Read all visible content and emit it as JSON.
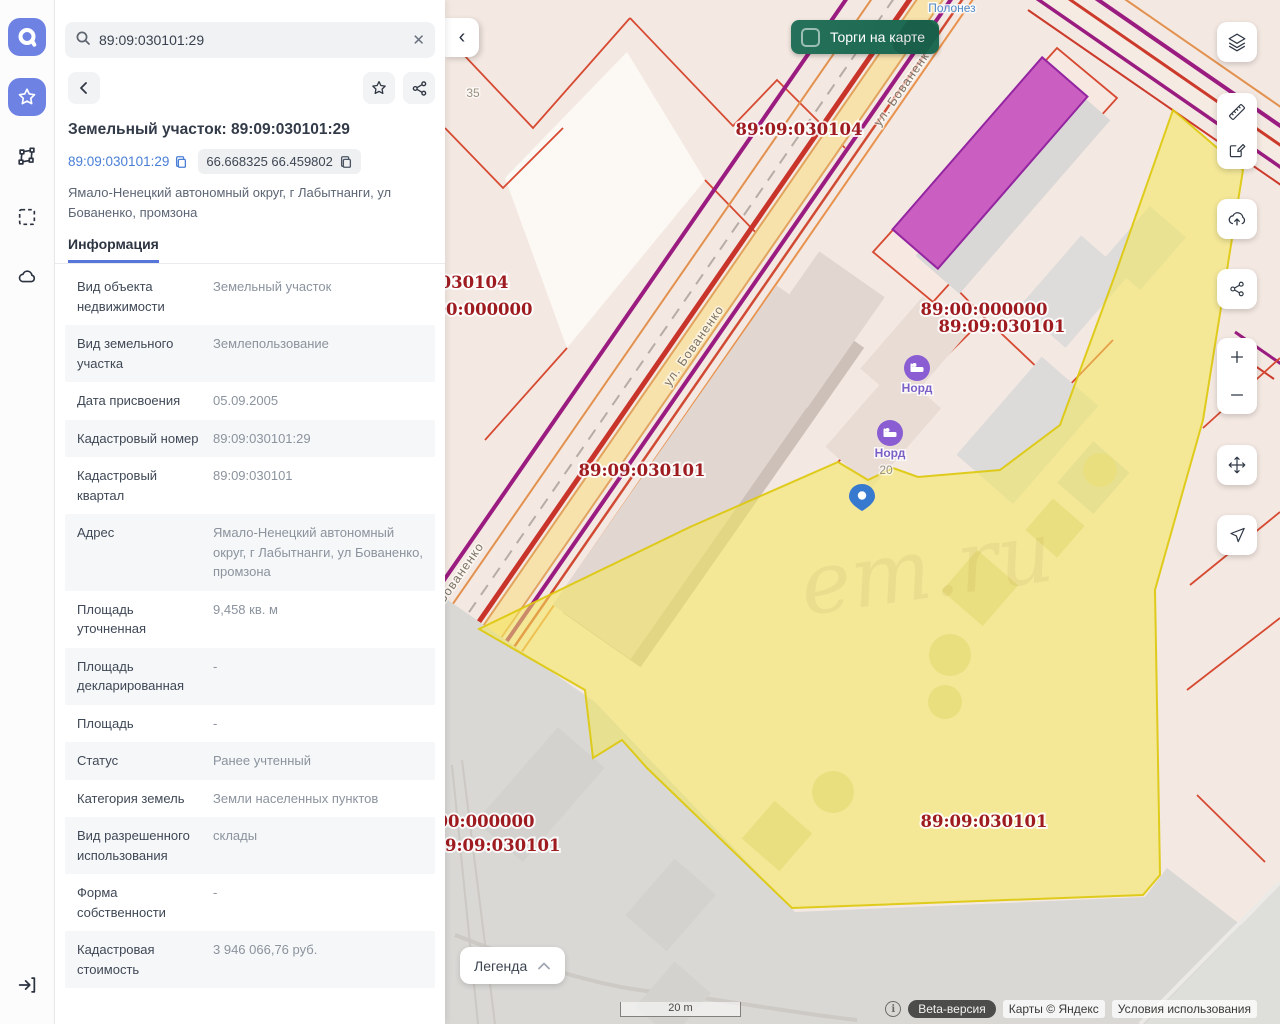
{
  "colors": {
    "accent_blue": "#6d82e3",
    "link_blue": "#4a7fd6",
    "tab_blue": "#5677d9",
    "toggle_green": "#1e6a52",
    "cad_red": "#9e1b20",
    "parcel_yellow": "#f2e261",
    "pin_blue": "#3879d0",
    "poi_purple": "#8a5ed2"
  },
  "rail": {
    "items": [
      "app-logo",
      "favorites",
      "polygon-select",
      "area-select",
      "cloud",
      "sign-in"
    ]
  },
  "search": {
    "value": "89:09:030101:29"
  },
  "details": {
    "title": "Земельный участок: 89:09:030101:29",
    "cadastral_link": "89:09:030101:29",
    "coordinates": "66.668325 66.459802",
    "address": "Ямало-Ненецкий автономный округ, г Лабытнанги, ул Бованенко, промзона",
    "tab": "Информация",
    "rows": [
      {
        "label": "Вид объекта недвижимости",
        "value": "Земельный участок"
      },
      {
        "label": "Вид земельного участка",
        "value": "Землепользование"
      },
      {
        "label": "Дата присвоения",
        "value": "05.09.2005"
      },
      {
        "label": "Кадастровый номер",
        "value": "89:09:030101:29"
      },
      {
        "label": "Кадастровый квартал",
        "value": "89:09:030101"
      },
      {
        "label": "Адрес",
        "value": "Ямало-Ненецкий автономный округ, г Лабытнанги, ул Бованенко, промзона"
      },
      {
        "label": "Площадь уточненная",
        "value": "9,458 кв. м"
      },
      {
        "label": "Площадь декларированная",
        "value": "-"
      },
      {
        "label": "Площадь",
        "value": "-"
      },
      {
        "label": "Статус",
        "value": "Ранее учтенный"
      },
      {
        "label": "Категория земель",
        "value": "Земли населенных пунктов"
      },
      {
        "label": "Вид разрешенного использования",
        "value": "склады"
      },
      {
        "label": "Форма собственности",
        "value": "-"
      },
      {
        "label": "Кадастровая стоимость",
        "value": "3 946 066,76 руб."
      }
    ]
  },
  "map": {
    "toggle_label": "Торги на карте",
    "legend_label": "Легенда",
    "scale_label": "20 m",
    "beta_label": "Beta-версия",
    "attribution": "Карты © Яндекс",
    "terms": "Условия использования",
    "controls": [
      "layers",
      "measure",
      "draw",
      "upload",
      "share",
      "zoom-in",
      "zoom-out",
      "pan",
      "locate"
    ],
    "labels": [
      {
        "text": "89:09:030104",
        "kind": "cadastral",
        "x": 354,
        "y": 135
      },
      {
        "text": "89:09:030104",
        "kind": "cadastral",
        "x": 0,
        "y": 288
      },
      {
        "text": "89:00:000000",
        "kind": "cadastral",
        "x": 24,
        "y": 315
      },
      {
        "text": "89:00:000000",
        "kind": "cadastral",
        "x": 539,
        "y": 315
      },
      {
        "text": "89:09:030101",
        "kind": "cadastral",
        "x": 557,
        "y": 332
      },
      {
        "text": "89:09:030101",
        "kind": "cadastral",
        "x": 197,
        "y": 476
      },
      {
        "text": "89:00:000000",
        "kind": "cadastral",
        "x": 26,
        "y": 827
      },
      {
        "text": "89:09:030101",
        "kind": "cadastral",
        "x": 52,
        "y": 851
      },
      {
        "text": "89:09:030101",
        "kind": "cadastral",
        "x": 539,
        "y": 827
      },
      {
        "text": "ул. Бованенко",
        "kind": "street",
        "x": 462,
        "y": 88,
        "rot": -55
      },
      {
        "text": "ул. Бованенко",
        "kind": "street",
        "x": 252,
        "y": 348,
        "rot": -55
      },
      {
        "text": "ул. Бованенко",
        "kind": "street",
        "x": 12,
        "y": 585,
        "rot": -55
      },
      {
        "text": "Полонез",
        "kind": "poi",
        "x": 507,
        "y": 12
      },
      {
        "text": "35",
        "kind": "num",
        "x": 28,
        "y": 97
      },
      {
        "text": "20",
        "kind": "num",
        "x": 441,
        "y": 474
      },
      {
        "text": "Норд",
        "kind": "nord",
        "x": 472,
        "y": 392
      },
      {
        "text": "Норд",
        "kind": "nord",
        "x": 445,
        "y": 457
      }
    ]
  }
}
